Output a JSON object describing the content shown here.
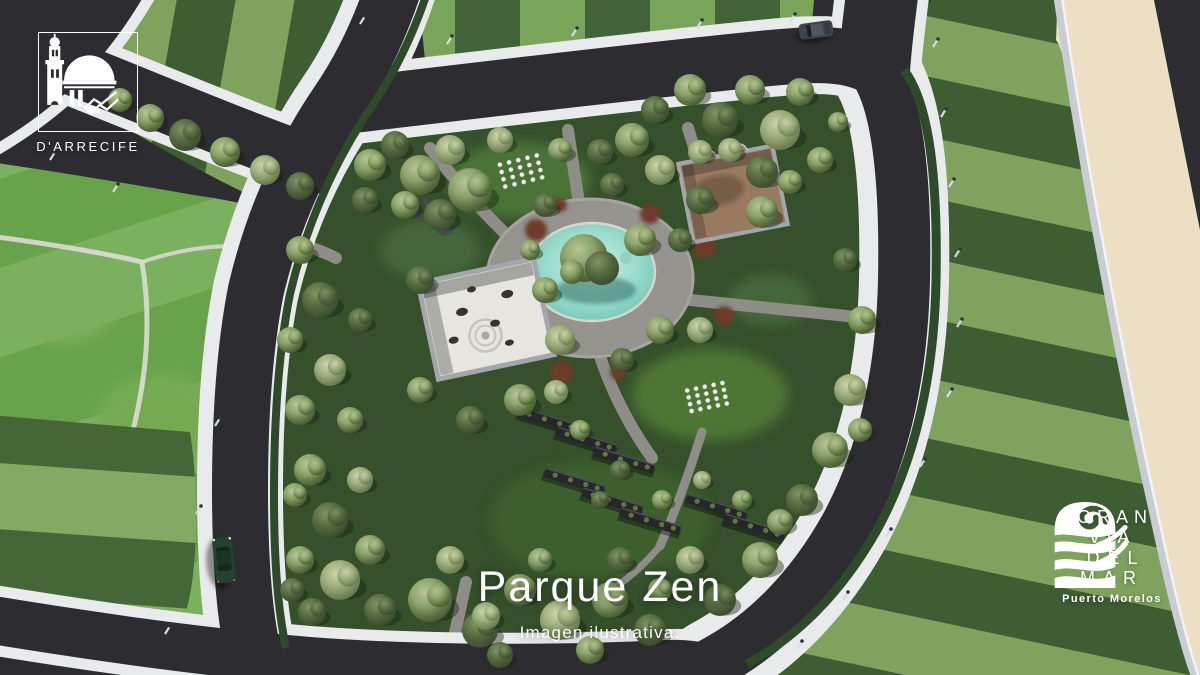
{
  "scene": {
    "description": "Aerial 3D render of a landscaped park block surrounded by roads, striped lawns and a sand strip",
    "features": [
      "central fountain pond with tree island",
      "zen gravel garden enclosure",
      "walled terracotta courtyard",
      "community garden pergola rows",
      "white event chairs on lawn",
      "green sedan on road",
      "dark suv on road"
    ]
  },
  "branding": {
    "developer_badge": {
      "label": "D'ARRECIFE"
    },
    "title": "Parque Zen",
    "subtitle": "Imagen ilustrativa.",
    "master_brand": {
      "line1": "GRAN VÍA",
      "line2": "DEL MAR",
      "tagline": "Puerto Morelos"
    }
  },
  "colors": {
    "asphalt": "#2d2c30",
    "sidewalk": "#e9eaec",
    "curb": "#c9cdd3",
    "lawn_dark": "#3e5d33",
    "lawn_light": "#7fa35e",
    "lawn_dark2": "#456636",
    "lawn_light2": "#83a964",
    "top_dark": "#42633a",
    "top_light": "#79a55a",
    "lawn_bright_a": "#68a34b",
    "lawn_bright_b": "#7bb05e",
    "park_ground": "#35502b",
    "glade": "#4d7635",
    "sand": "#ecdfc4",
    "pond_light": "#cdeee6",
    "pond_mid": "#9adccd",
    "pond_deep": "#6bbfae",
    "plaza": "#94938e",
    "path": "#8e8d88",
    "gravel": "#e7e5df",
    "terracotta": "#9a7961",
    "wall": "#a3a6ab",
    "shrub_red": "#6e3a2b",
    "hedge": "#2f4a2a",
    "car_green": "#24422f",
    "car_suv": "#3f434b",
    "text": "#ffffff"
  }
}
